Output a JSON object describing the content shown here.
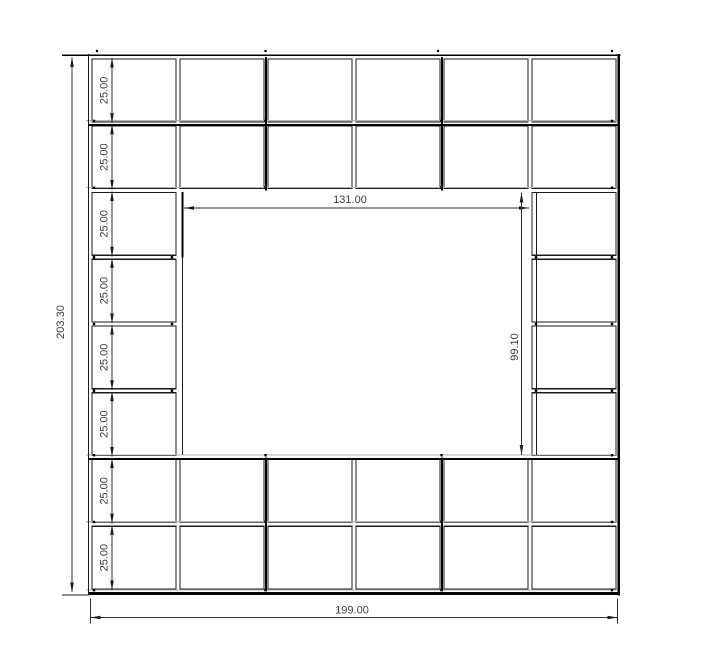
{
  "drawing": {
    "dimensions": {
      "total_height": "203.30",
      "total_width": "199.00",
      "opening_width": "131.00",
      "opening_height": "99.10",
      "row_heights": [
        "25.00",
        "25.00",
        "25.00",
        "25.00",
        "25.00",
        "25.00",
        "25.00",
        "25.00"
      ]
    },
    "colors": {
      "background": "#ffffff",
      "line": "#1b1b1b",
      "thick_line": "#000000",
      "panel_line": "#b5b5b5",
      "dimension_line": "#2e2e2e",
      "dimension_text": "#3d3d3d"
    }
  }
}
